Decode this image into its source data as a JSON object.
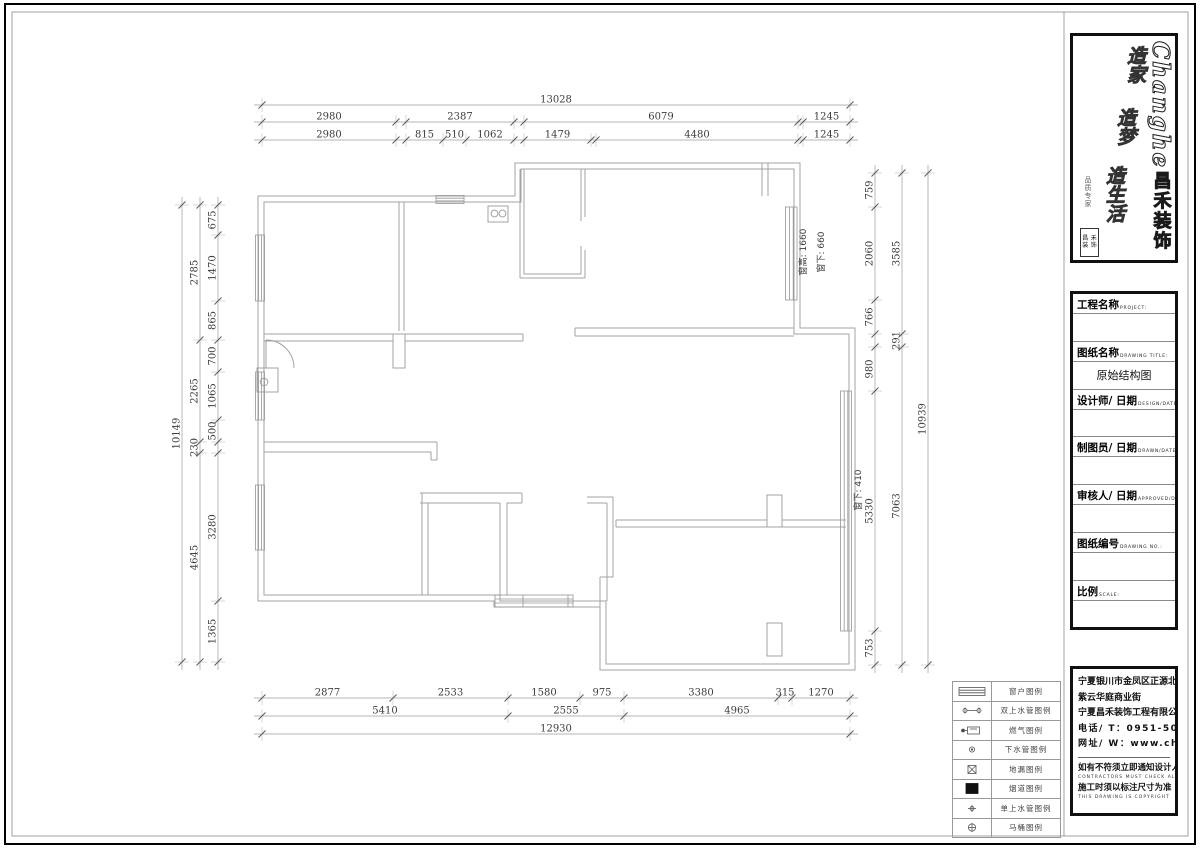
{
  "sheet": {
    "drawing_title": "原始结构图"
  },
  "logo": {
    "brand_en": "Changhe",
    "brand_cn": "昌禾装饰",
    "slogans": [
      "造家",
      "造梦",
      "造生活"
    ],
    "signature": "品质专家",
    "seal_chars": [
      "昌",
      "禾",
      "装",
      "饰"
    ]
  },
  "title_block": {
    "fields": [
      {
        "cn": "工程名称",
        "en": "PROJECT:",
        "value": ""
      },
      {
        "cn": "图纸名称",
        "en": "DRAWING TITLE:",
        "value": "原始结构图"
      },
      {
        "cn": "设计师/ 日期",
        "en": "DESIGN/DATE:",
        "value": ""
      },
      {
        "cn": "制图员/ 日期",
        "en": "DRAWN/DATE:",
        "value": ""
      },
      {
        "cn": "审核人/ 日期",
        "en": "APPROVED/DATE:",
        "value": ""
      },
      {
        "cn": "图纸编号",
        "en": "DRAWING NO.:",
        "value": ""
      },
      {
        "cn": "比例",
        "en": "SCALE:",
        "value": ""
      }
    ]
  },
  "contact": {
    "address1": "宁夏银川市金凤区正源北街",
    "address2": "紫云华庭商业街",
    "company": "宁夏昌禾装饰工程有限公司",
    "phone": "电话/ T：0951-5047688",
    "website": "网址/ W：www.chzs.net",
    "note1_cn": "如有不符须立即通知设计人员",
    "note1_en": "CONTRACTORS MUST CHECK ALL D",
    "note2_cn": "施工时须以标注尺寸为准",
    "note2_en": "THIS DRAWING IS COPYRIGHT"
  },
  "legend": {
    "rows": [
      {
        "symbol": "window",
        "label": "窗户图例"
      },
      {
        "symbol": "double-water",
        "label": "双上水管图例"
      },
      {
        "symbol": "gas",
        "label": "燃气图例"
      },
      {
        "symbol": "drain-pipe",
        "label": "下水管图例"
      },
      {
        "symbol": "floor-drain",
        "label": "地漏图例"
      },
      {
        "symbol": "flue",
        "label": "烟道图例"
      },
      {
        "symbol": "single-water",
        "label": "单上水管图例"
      },
      {
        "symbol": "toilet",
        "label": "马桶图例"
      }
    ]
  },
  "plan": {
    "annotations": [
      {
        "text": "窗高: 1660",
        "x": 806,
        "y": 252
      },
      {
        "text": "窗下: 660",
        "x": 824,
        "y": 252
      },
      {
        "text": "窗下: 410",
        "x": 861,
        "y": 490
      }
    ]
  },
  "dimensions": {
    "chains": [
      {
        "axis": "h",
        "pos": 105,
        "segs": [
          {
            "l": "13028",
            "a": 262,
            "b": 850
          }
        ]
      },
      {
        "axis": "h",
        "pos": 122,
        "segs": [
          {
            "l": "2980",
            "a": 262,
            "b": 396
          },
          {
            "l": "2387",
            "a": 406,
            "b": 514
          },
          {
            "l": "6079",
            "a": 524,
            "b": 798
          },
          {
            "l": "1245",
            "a": 803,
            "b": 850
          }
        ]
      },
      {
        "axis": "h",
        "pos": 140,
        "segs": [
          {
            "l": "2980",
            "a": 262,
            "b": 396
          },
          {
            "l": "815",
            "a": 406,
            "b": 443
          },
          {
            "l": "510",
            "a": 443,
            "b": 466
          },
          {
            "l": "1062",
            "a": 466,
            "b": 514
          },
          {
            "l": "1479",
            "a": 524,
            "b": 591
          },
          {
            "l": "4480",
            "a": 596,
            "b": 798
          },
          {
            "l": "1245",
            "a": 803,
            "b": 850
          }
        ]
      },
      {
        "axis": "h",
        "pos": 698,
        "segs": [
          {
            "l": "2877",
            "a": 262,
            "b": 393
          },
          {
            "l": "2533",
            "a": 393,
            "b": 508
          },
          {
            "l": "1580",
            "a": 508,
            "b": 580
          },
          {
            "l": "975",
            "a": 580,
            "b": 624
          },
          {
            "l": "3380",
            "a": 624,
            "b": 778
          },
          {
            "l": "315",
            "a": 778,
            "b": 792
          },
          {
            "l": "1270",
            "a": 792,
            "b": 850
          }
        ]
      },
      {
        "axis": "h",
        "pos": 716,
        "segs": [
          {
            "l": "5410",
            "a": 262,
            "b": 508
          },
          {
            "l": "2555",
            "a": 508,
            "b": 624
          },
          {
            "l": "4965",
            "a": 624,
            "b": 850
          }
        ]
      },
      {
        "axis": "h",
        "pos": 734,
        "segs": [
          {
            "l": "12930",
            "a": 262,
            "b": 850
          }
        ]
      },
      {
        "axis": "v",
        "pos": 182,
        "segs": [
          {
            "l": "10149",
            "a": 205,
            "b": 662
          }
        ]
      },
      {
        "axis": "v",
        "pos": 200,
        "segs": [
          {
            "l": "2785",
            "a": 205,
            "b": 340
          },
          {
            "l": "2265",
            "a": 340,
            "b": 442
          },
          {
            "l": "230",
            "a": 442,
            "b": 453
          },
          {
            "l": "4645",
            "a": 453,
            "b": 662
          }
        ]
      },
      {
        "axis": "v",
        "pos": 218,
        "segs": [
          {
            "l": "675",
            "a": 205,
            "b": 235
          },
          {
            "l": "1470",
            "a": 235,
            "b": 301
          },
          {
            "l": "865",
            "a": 301,
            "b": 340
          },
          {
            "l": "700",
            "a": 340,
            "b": 372
          },
          {
            "l": "1065",
            "a": 372,
            "b": 420
          },
          {
            "l": "500",
            "a": 420,
            "b": 442
          },
          {
            "l": "3280",
            "a": 453,
            "b": 601
          },
          {
            "l": "1365",
            "a": 601,
            "b": 662
          }
        ]
      },
      {
        "axis": "v",
        "pos": 875,
        "segs": [
          {
            "l": "759",
            "a": 173,
            "b": 207
          },
          {
            "l": "2060",
            "a": 207,
            "b": 300
          },
          {
            "l": "766",
            "a": 300,
            "b": 334
          },
          {
            "l": "980",
            "a": 347,
            "b": 391
          },
          {
            "l": "5330",
            "a": 391,
            "b": 631
          },
          {
            "l": "753",
            "a": 631,
            "b": 665
          }
        ]
      },
      {
        "axis": "v",
        "pos": 902,
        "segs": [
          {
            "l": "3585",
            "a": 173,
            "b": 334
          },
          {
            "l": "291",
            "a": 334,
            "b": 347
          },
          {
            "l": "7063",
            "a": 347,
            "b": 665
          }
        ]
      },
      {
        "axis": "v",
        "pos": 928,
        "segs": [
          {
            "l": "10939",
            "a": 173,
            "b": 665
          }
        ]
      }
    ]
  }
}
